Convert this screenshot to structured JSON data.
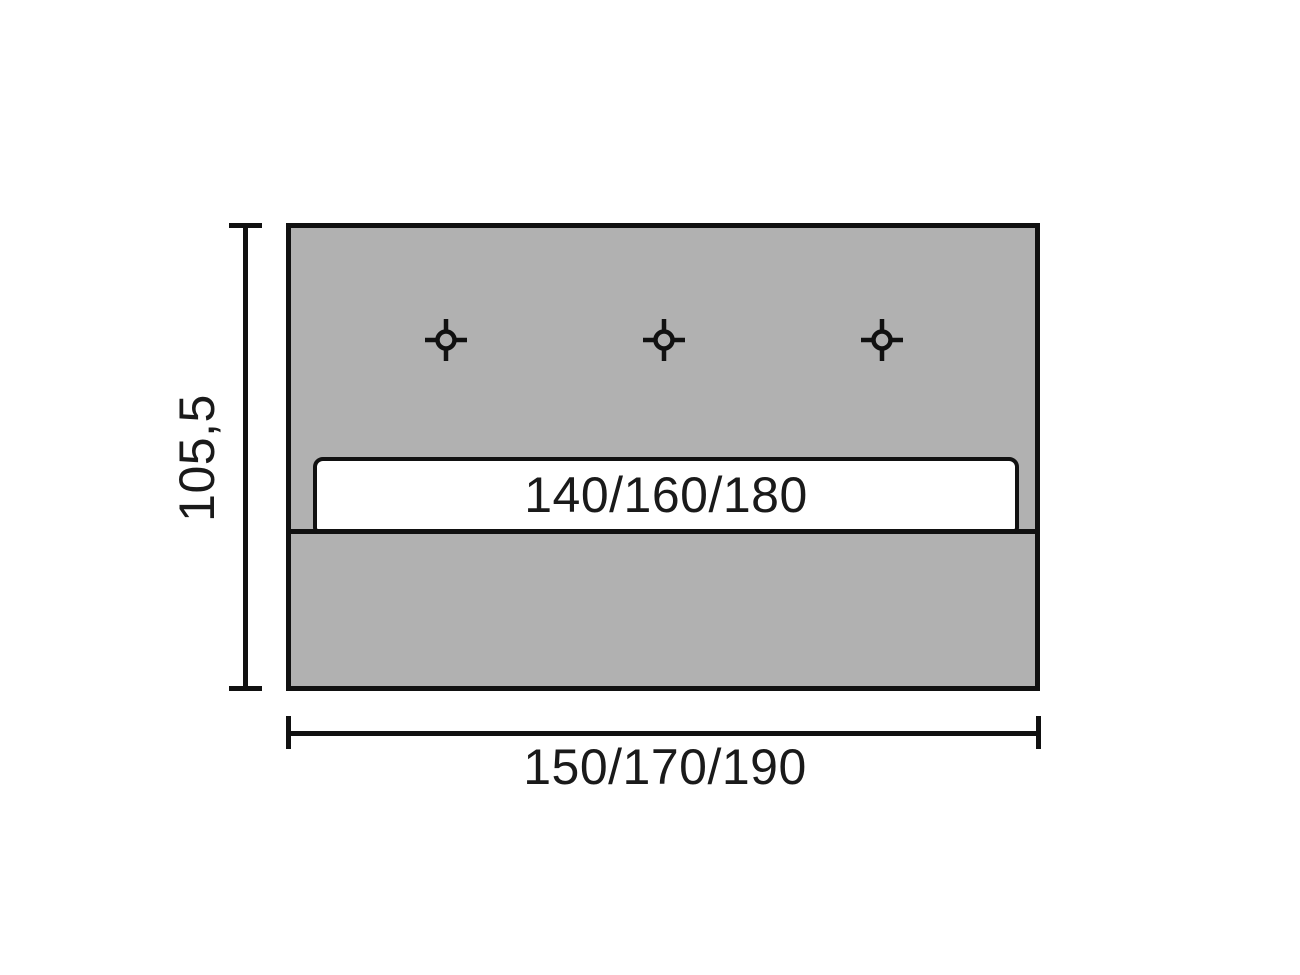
{
  "drawing": {
    "height_label": "105,5",
    "width_label": "150/170/190",
    "insert_bar_label": "140/160/180",
    "marker_icon": "crosshair-position-marker",
    "marker_count": 3,
    "colors": {
      "panel_fill": "#b1b1b1",
      "stroke": "#111111",
      "insert_fill": "#ffffff",
      "canvas": "#ffffff"
    }
  }
}
